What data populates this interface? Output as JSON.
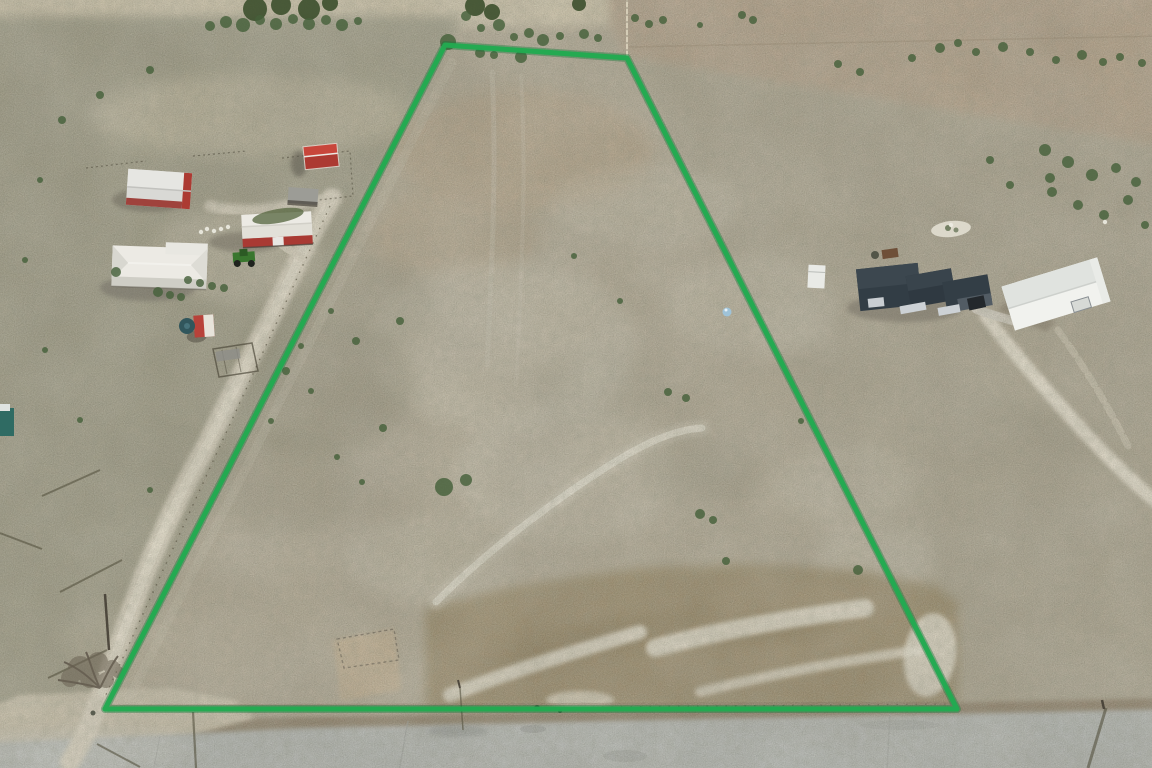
{
  "meta": {
    "title": "Aerial drone photograph of a rural land parcel outlined with a green property boundary",
    "width": 1152,
    "height": 768,
    "kind": "real-estate aerial photo, no visible text"
  },
  "boundary": {
    "label": "property-boundary-outline",
    "color": "#22aa51",
    "glow_color": "#117a36",
    "stroke_width": "5",
    "glow_width": "8",
    "points_str": "445,45 627,58 957,709 105,709",
    "vertices": [
      [
        445,
        45
      ],
      [
        627,
        58
      ],
      [
        957,
        709
      ],
      [
        105,
        709
      ]
    ],
    "shape": "long trapezoid, narrow at top, full-width at road frontage"
  },
  "palette": {
    "base": "#b2a994",
    "top_strip": "#cfc5ab",
    "pasture_left": "#9e9b85",
    "scrub_top_right": "#b4a189",
    "pasture_right": "#aca48f",
    "parcel_pink": "#b7a183",
    "light_blotch": "#d0cab8",
    "dark_blotch": "#8e8a74",
    "wash_brown": "#9a8a69",
    "sand": "#eae5d5",
    "caliche_road": "#ded6c3",
    "caliche_core": "#e9e2d0",
    "pavement": "#b5b8b4",
    "shoulder": "#8c7d66",
    "dirt_junction": "#cdc4ae",
    "bush_green": "#46603a",
    "tree_dark": "#3c4f2c",
    "shadow": "#55523f",
    "white_roof": "#eceae4",
    "silver_roof": "#d9d9d5",
    "red_barn": "#ac3a32",
    "dark_roof": "#323d45",
    "metal_white": "#f1f2ee",
    "teal_tank": "#31565c",
    "teal_roof": "#2f6b63",
    "grass_patch": "#5d6b46",
    "blue_barrel": "#9fc3d8",
    "tractor_green": "#39762e",
    "speck_white": "#ecebe1"
  },
  "features": {
    "left_farmstead": {
      "label": "neighboring farmstead west of parcel",
      "items": [
        {
          "name": "metal-roof-barn",
          "desc": "barn with silver metal roof and red walls",
          "x": 159,
          "y": 189
        },
        {
          "name": "red-shed",
          "desc": "small red shed with white trim",
          "x": 321,
          "y": 156
        },
        {
          "name": "red-white-barn",
          "desc": "white-roof barn with red walls and white sliding door",
          "x": 277,
          "y": 229
        },
        {
          "name": "farmhouse",
          "desc": "house with white hip roof and wrap porch",
          "x": 160,
          "y": 267
        },
        {
          "name": "loafing-shed",
          "desc": "open-front gray shelter",
          "x": 303,
          "y": 196
        },
        {
          "name": "tank-shed",
          "desc": "red/white well shed with dark round water tank",
          "x": 204,
          "y": 326
        },
        {
          "name": "cattle-pen",
          "desc": "small metal stock pen",
          "x": 235,
          "y": 360
        },
        {
          "name": "green-tractor",
          "desc": "green farm tractor",
          "x": 244,
          "y": 259
        },
        {
          "name": "teal-roof-structure",
          "desc": "teal-roof structure at left image edge",
          "x": 6,
          "y": 422
        }
      ]
    },
    "right_homestead": {
      "label": "neighboring homestead east of parcel",
      "items": [
        {
          "name": "house-dark-roof",
          "desc": "ranch house with dark charcoal hip roof and light walls",
          "x": 925,
          "y": 287
        },
        {
          "name": "white-metal-shop",
          "desc": "white metal shop/barn building",
          "x": 1056,
          "y": 294
        },
        {
          "name": "camper-trailer",
          "desc": "small white camper trailer",
          "x": 816,
          "y": 276
        },
        {
          "name": "parked-vehicle",
          "desc": "dark vehicle under carport",
          "x": 976,
          "y": 303
        }
      ]
    },
    "roads": {
      "paved_road": "gray county road running along the bottom edge",
      "caliche_road": "white caliche lane climbing the west side, parallel to boundary",
      "east_driveway": "bright white gravel driveway curving from east house to right edge",
      "west_spur": "dirt spur from lane to west farmstead"
    },
    "parcel_details": [
      "open scrub pasture, gray-tan grass",
      "faint white two-track trail crossing the middle diagonally",
      "sandy wash with tall brown grass across the south end",
      "bare dirt patch with small wire pen near southwest corner",
      "scattered dark green mesquite shrubs",
      "light blue barrel near the east boundary line"
    ],
    "misc": {
      "bare_tree": {
        "desc": "leafless tree at southwest boundary corner",
        "x": 92,
        "y": 672
      },
      "power_line": "utility pole shadows along the west lane and across the paved road",
      "blue_barrel": {
        "x": 727,
        "y": 312
      },
      "fence_top": "wire fence line running to the top edge above the parcel apex"
    }
  },
  "scatter": {
    "bushes": [
      [
        210,
        26,
        5
      ],
      [
        226,
        22,
        6
      ],
      [
        243,
        25,
        7
      ],
      [
        260,
        20,
        5
      ],
      [
        276,
        24,
        6
      ],
      [
        293,
        19,
        5
      ],
      [
        309,
        24,
        6
      ],
      [
        326,
        20,
        5
      ],
      [
        342,
        25,
        6
      ],
      [
        358,
        21,
        4
      ],
      [
        466,
        16,
        5
      ],
      [
        481,
        28,
        4
      ],
      [
        499,
        25,
        6
      ],
      [
        514,
        37,
        4
      ],
      [
        529,
        33,
        5
      ],
      [
        543,
        40,
        6
      ],
      [
        560,
        36,
        4
      ],
      [
        584,
        34,
        5
      ],
      [
        598,
        38,
        4
      ],
      [
        521,
        57,
        6
      ],
      [
        480,
        53,
        5
      ],
      [
        448,
        42,
        8
      ],
      [
        494,
        55,
        4
      ],
      [
        635,
        18,
        4
      ],
      [
        649,
        24,
        4
      ],
      [
        663,
        20,
        4
      ],
      [
        700,
        25,
        3
      ],
      [
        742,
        15,
        4
      ],
      [
        753,
        20,
        4
      ],
      [
        838,
        64,
        4
      ],
      [
        860,
        72,
        4
      ],
      [
        912,
        58,
        4
      ],
      [
        940,
        48,
        5
      ],
      [
        958,
        43,
        4
      ],
      [
        976,
        52,
        4
      ],
      [
        1003,
        47,
        5
      ],
      [
        1030,
        52,
        4
      ],
      [
        1056,
        60,
        4
      ],
      [
        1082,
        55,
        5
      ],
      [
        1103,
        62,
        4
      ],
      [
        1120,
        57,
        4
      ],
      [
        1142,
        63,
        4
      ],
      [
        1045,
        150,
        6
      ],
      [
        1068,
        162,
        6
      ],
      [
        1092,
        175,
        6
      ],
      [
        1116,
        168,
        5
      ],
      [
        1136,
        182,
        5
      ],
      [
        1052,
        192,
        5
      ],
      [
        1078,
        205,
        5
      ],
      [
        1104,
        215,
        5
      ],
      [
        1128,
        200,
        5
      ],
      [
        1145,
        225,
        4
      ],
      [
        1050,
        178,
        5
      ],
      [
        990,
        160,
        4
      ],
      [
        1010,
        185,
        4
      ],
      [
        444,
        487,
        9
      ],
      [
        466,
        480,
        6
      ],
      [
        383,
        428,
        4
      ],
      [
        668,
        392,
        4
      ],
      [
        686,
        398,
        4
      ],
      [
        700,
        514,
        5
      ],
      [
        713,
        520,
        4
      ],
      [
        726,
        561,
        4
      ],
      [
        858,
        570,
        5
      ],
      [
        801,
        421,
        3
      ],
      [
        620,
        301,
        3
      ],
      [
        574,
        256,
        3
      ],
      [
        400,
        321,
        4
      ],
      [
        356,
        341,
        4
      ],
      [
        331,
        311,
        3
      ],
      [
        301,
        346,
        3
      ],
      [
        286,
        371,
        4
      ],
      [
        311,
        391,
        3
      ],
      [
        271,
        421,
        3
      ],
      [
        337,
        457,
        3
      ],
      [
        362,
        482,
        3
      ],
      [
        116,
        272,
        5
      ],
      [
        188,
        280,
        4
      ],
      [
        200,
        283,
        4
      ],
      [
        212,
        286,
        4
      ],
      [
        224,
        288,
        4
      ],
      [
        158,
        292,
        5
      ],
      [
        170,
        295,
        4
      ],
      [
        181,
        297,
        4
      ],
      [
        62,
        120,
        4
      ],
      [
        100,
        95,
        4
      ],
      [
        150,
        70,
        4
      ],
      [
        40,
        180,
        3
      ],
      [
        25,
        260,
        3
      ],
      [
        150,
        490,
        3
      ],
      [
        80,
        420,
        3
      ],
      [
        45,
        350,
        3
      ]
    ],
    "trees": [
      [
        255,
        9,
        12
      ],
      [
        281,
        5,
        10
      ],
      [
        309,
        9,
        11
      ],
      [
        330,
        3,
        8
      ],
      [
        475,
        6,
        10
      ],
      [
        492,
        12,
        8
      ],
      [
        579,
        4,
        7
      ]
    ],
    "white_specks": [
      [
        207,
        229
      ],
      [
        214,
        231
      ],
      [
        221,
        229
      ],
      [
        228,
        227
      ],
      [
        201,
        232
      ],
      [
        951,
        225
      ],
      [
        1105,
        222
      ]
    ],
    "dark_dots": [
      [
        537,
        708,
        3
      ],
      [
        560,
        711,
        2
      ],
      [
        93,
        713,
        2.5
      ],
      [
        875,
        255,
        4
      ]
    ],
    "shadow_lines": [
      [
        100,
        470,
        42,
        496,
        2
      ],
      [
        122,
        560,
        60,
        592,
        2
      ],
      [
        107,
        650,
        48,
        678,
        2
      ],
      [
        0,
        533,
        42,
        549,
        2
      ],
      [
        193,
        712,
        196,
        768,
        2.2
      ],
      [
        97,
        744,
        140,
        767,
        2
      ],
      [
        1106,
        708,
        1088,
        768,
        3
      ],
      [
        460,
        688,
        463,
        730,
        1.5
      ]
    ],
    "poles": [
      [
        105,
        594,
        109,
        650,
        2.5
      ],
      [
        1102,
        700,
        1104,
        709,
        2.5
      ],
      [
        458,
        680,
        460,
        688,
        2
      ]
    ]
  }
}
